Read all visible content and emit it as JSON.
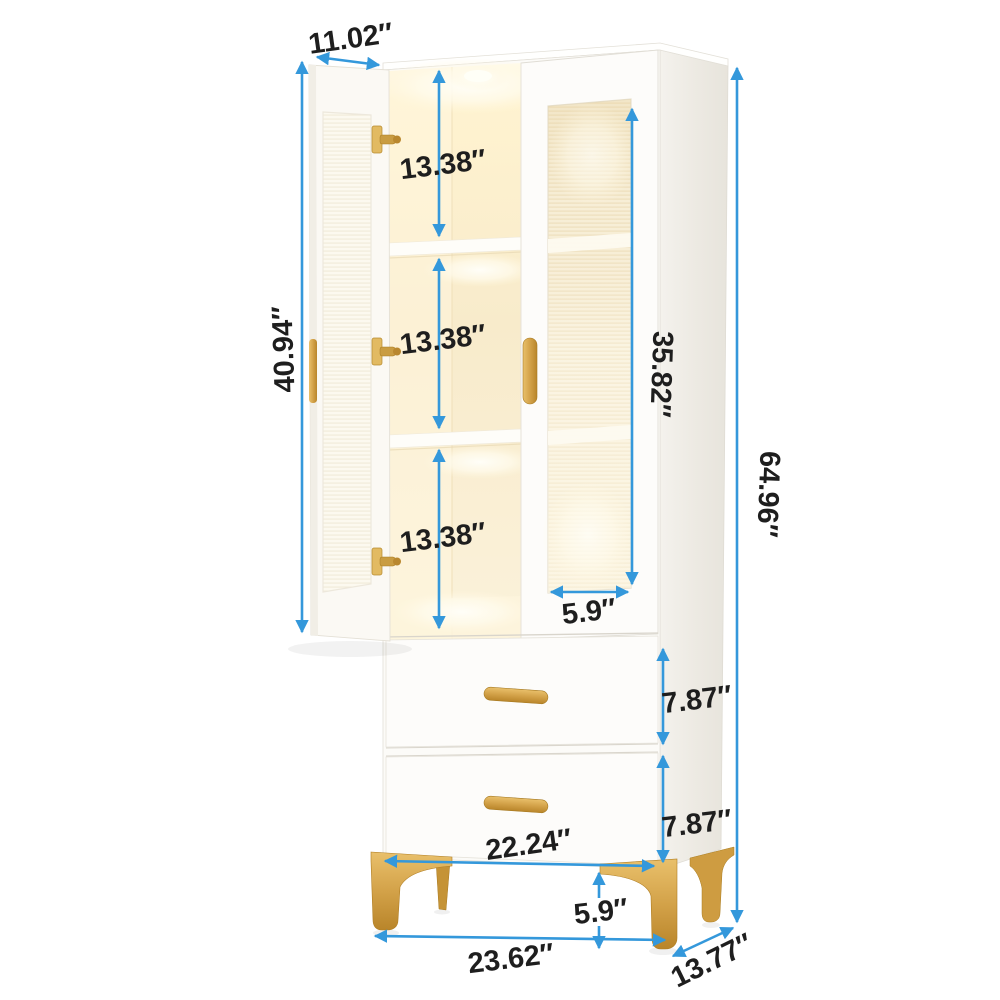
{
  "figure": {
    "kind": "furniture-dimension-diagram",
    "subject": "tall white bookcase cabinet with two fluted-glass doors, LED-lit shelves, two drawers and gold legs"
  },
  "style": {
    "accent_blue": "#3498db",
    "label_color": "#1e1e1e",
    "gold": "#CFA04A",
    "interior_glow": "#FFF3D2",
    "side_panel": "#EFEDE7"
  },
  "dims": {
    "door_width": "11.02″",
    "door_height": "40.94″",
    "shelf_gap_top": "13.38″",
    "shelf_gap_middle": "13.38″",
    "shelf_gap_bottom": "13.38″",
    "glass_door_height": "35.82″",
    "glass_width": "5.9″",
    "total_height": "64.96″",
    "drawer1_height": "7.87″",
    "drawer2_height": "7.87″",
    "drawer_width": "22.24″",
    "leg_height": "5.9″",
    "base_width": "23.62″",
    "base_depth": "13.77″"
  }
}
